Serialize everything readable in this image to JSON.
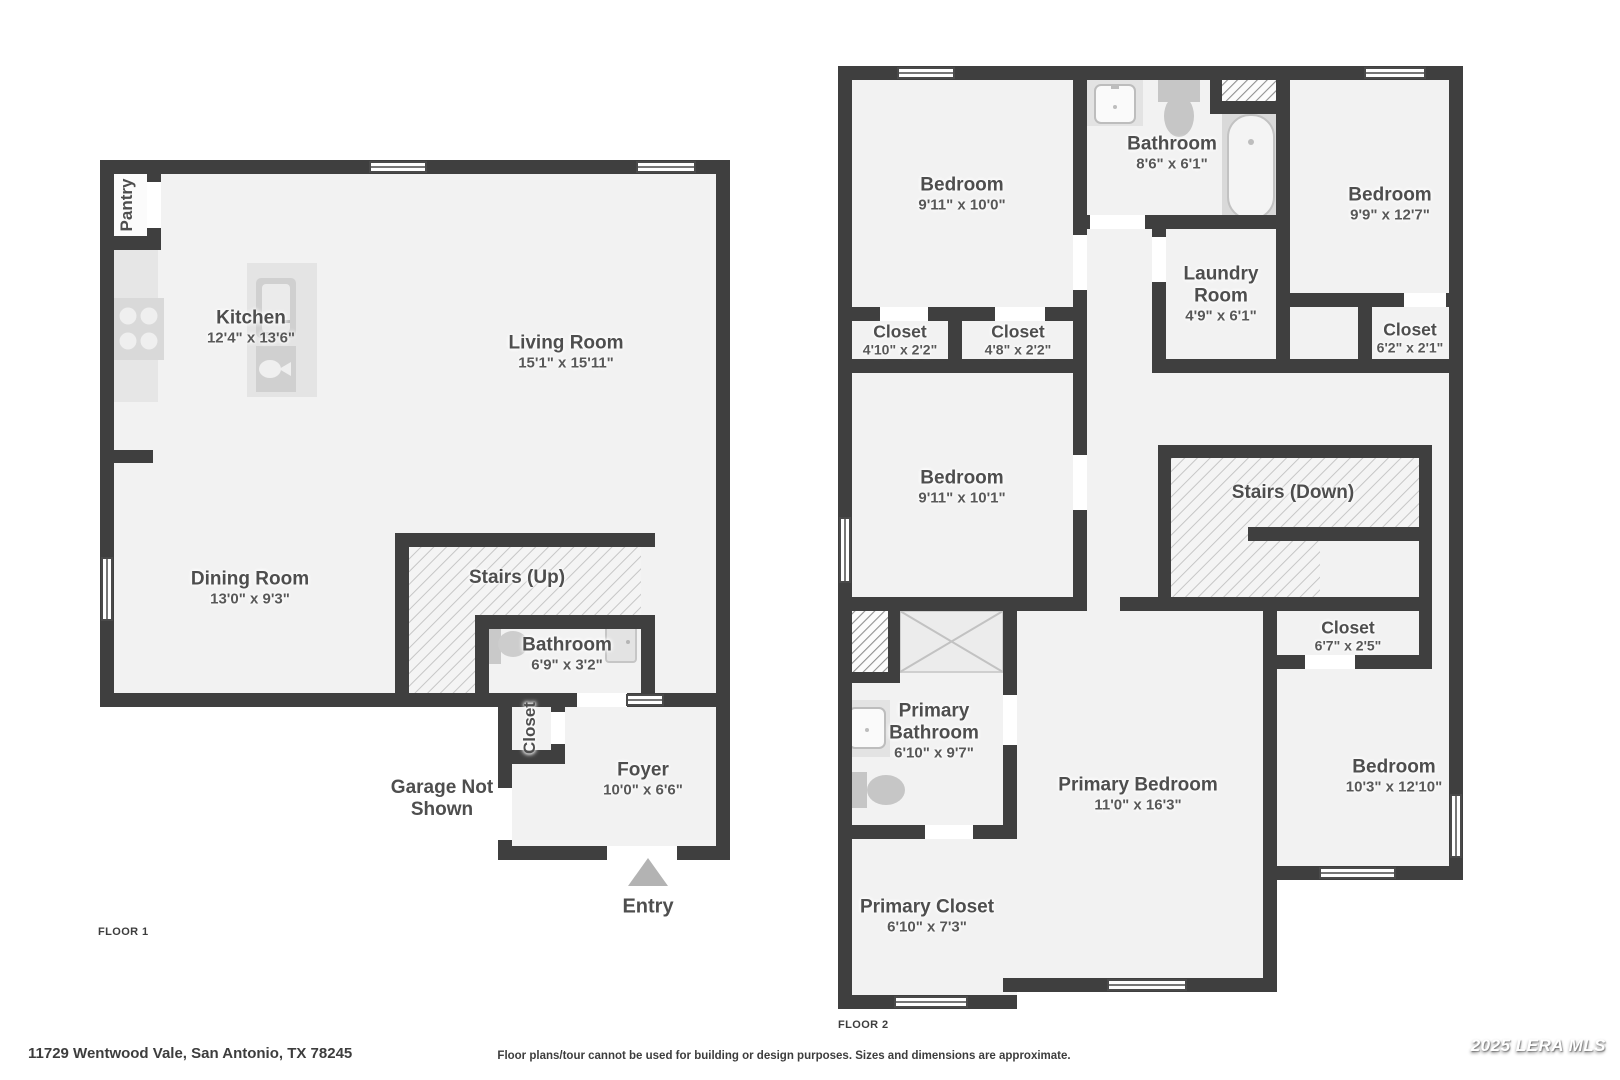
{
  "floor1": {
    "tag": "FLOOR 1",
    "rooms": {
      "pantry": {
        "name": "Pantry"
      },
      "kitchen": {
        "name": "Kitchen",
        "dims": "12'4\" x 13'6\""
      },
      "living_room": {
        "name": "Living Room",
        "dims": "15'1\" x 15'11\""
      },
      "dining_room": {
        "name": "Dining Room",
        "dims": "13'0\" x 9'3\""
      },
      "stairs": {
        "name": "Stairs (Up)"
      },
      "bathroom": {
        "name": "Bathroom",
        "dims": "6'9\" x 3'2\""
      },
      "closet": {
        "name": "Closet"
      },
      "foyer": {
        "name": "Foyer",
        "dims": "10'0\" x 6'6\""
      }
    },
    "garage_note_line1": "Garage Not",
    "garage_note_line2": "Shown",
    "entry_label": "Entry"
  },
  "floor2": {
    "tag": "FLOOR 2",
    "rooms": {
      "bedroom_top_left": {
        "name": "Bedroom",
        "dims": "9'11\" x 10'0\""
      },
      "bathroom": {
        "name": "Bathroom",
        "dims": "8'6\" x 6'1\""
      },
      "laundry": {
        "name_line1": "Laundry",
        "name_line2": "Room",
        "dims": "4'9\" x 6'1\""
      },
      "bedroom_top_right": {
        "name": "Bedroom",
        "dims": "9'9\" x 12'7\""
      },
      "closet_a": {
        "name": "Closet",
        "dims": "4'10\" x 2'2\""
      },
      "closet_b": {
        "name": "Closet",
        "dims": "4'8\" x 2'2\""
      },
      "closet_c": {
        "name": "Closet",
        "dims": "6'2\" x 2'1\""
      },
      "bedroom_middle": {
        "name": "Bedroom",
        "dims": "9'11\" x 10'1\""
      },
      "stairs": {
        "name": "Stairs (Down)"
      },
      "closet_d": {
        "name": "Closet",
        "dims": "6'7\" x 2'5\""
      },
      "primary_bathroom": {
        "name_line1": "Primary",
        "name_line2": "Bathroom",
        "dims": "6'10\" x 9'7\""
      },
      "primary_closet": {
        "name": "Primary Closet",
        "dims": "6'10\" x 7'3\""
      },
      "primary_bedroom": {
        "name": "Primary Bedroom",
        "dims": "11'0\" x 16'3\""
      },
      "bedroom_bottom_right": {
        "name": "Bedroom",
        "dims": "10'3\" x 12'10\""
      }
    }
  },
  "footer": {
    "address": "11729 Wentwood Vale, San Antonio, TX 78245",
    "disclaimer": "Floor plans/tour cannot be used for building or design purposes. Sizes and dimensions are approximate.",
    "watermark": "2025 LERA MLS"
  },
  "icons": {
    "entry_marker": "up-triangle",
    "hatch_area": "diagonal-stripes"
  },
  "colors": {
    "wall": "#3f3f3f",
    "floor": "#f2f2f2",
    "fixture": "#c9c9c9",
    "hatch_line": "#c6c6c6",
    "label_text": "#4e4e4e"
  }
}
